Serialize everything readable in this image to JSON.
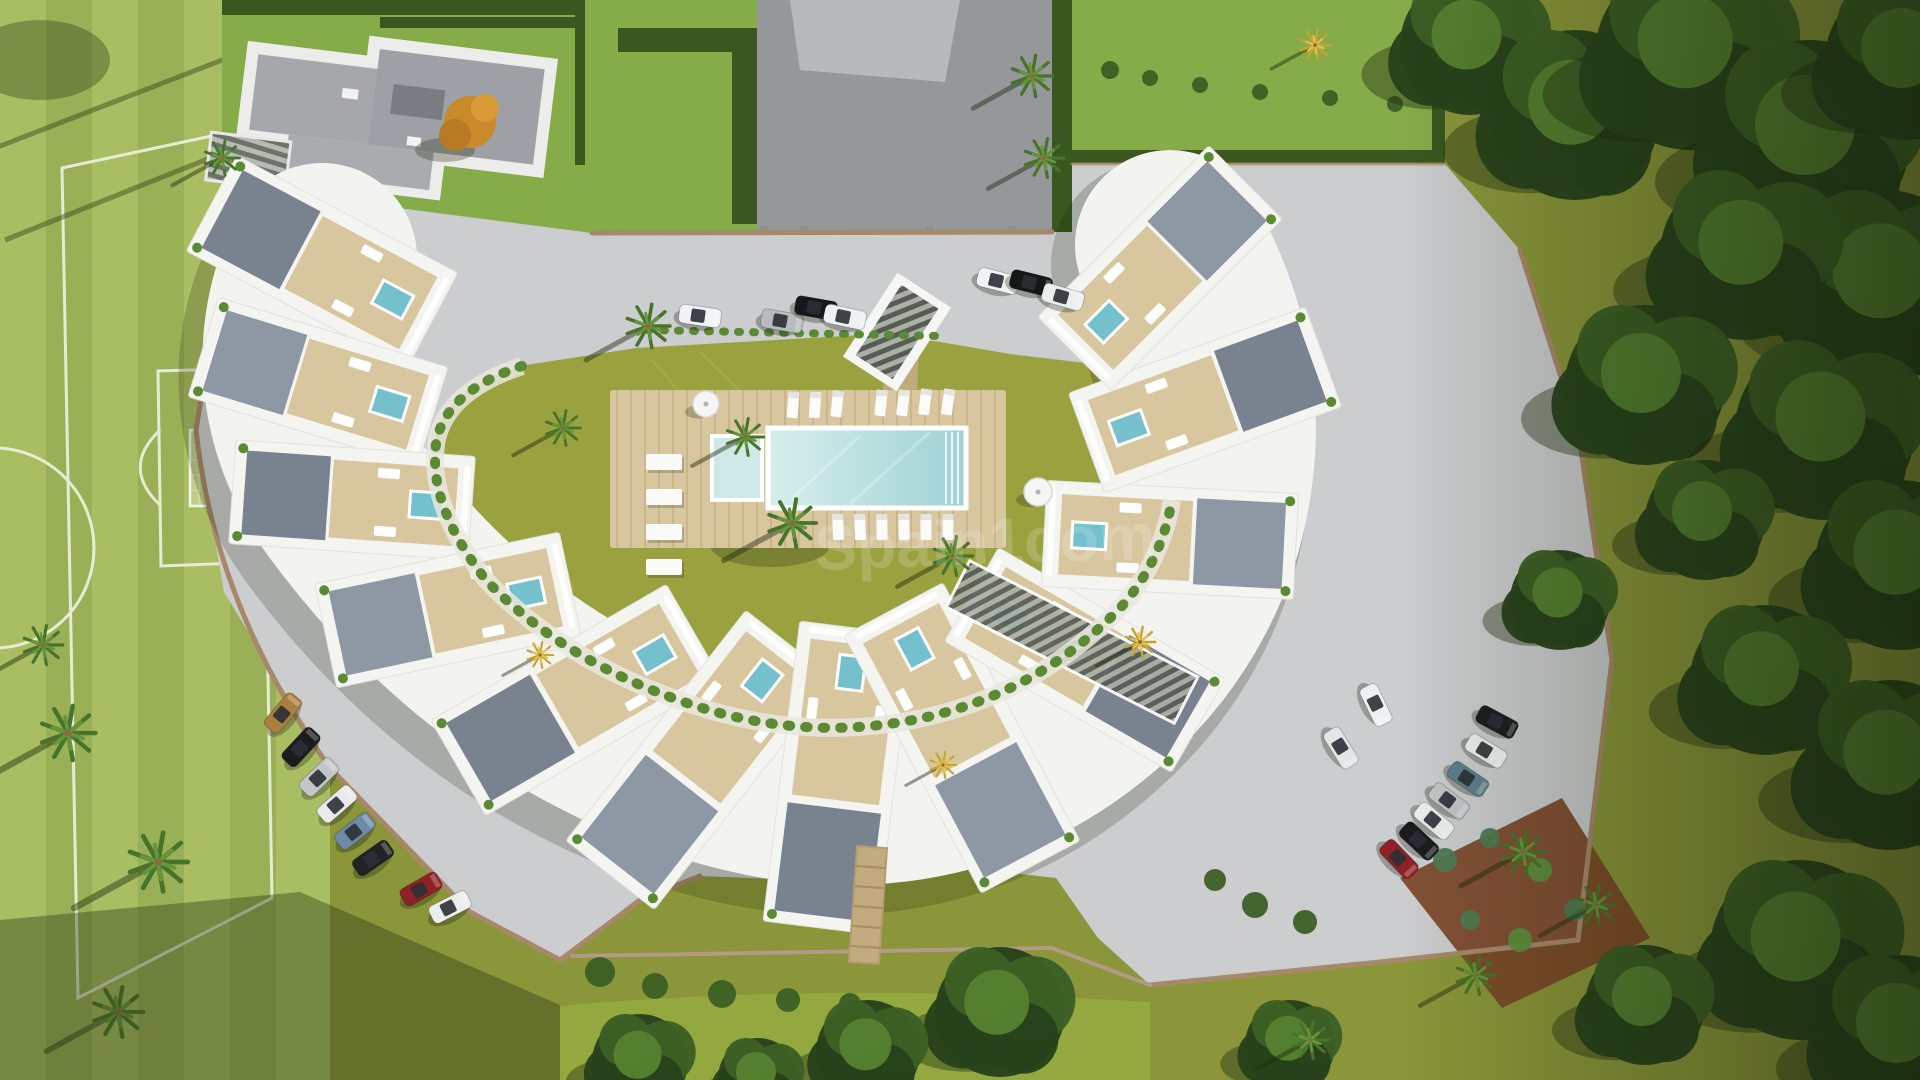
{
  "meta": {
    "description": "Aerial 3D render of a crescent-shaped apartment complex with communal pool, gardens, parking and a football pitch"
  },
  "watermark": {
    "text": "Spain1com",
    "color": "#ffffff",
    "opacity": 0.17
  },
  "palette": {
    "pitch_light": "#a9bd62",
    "pitch_dark": "#9ab056",
    "line": "#edf1de",
    "lawn_yellow": "#9aa23f",
    "lawn_bright": "#86ab49",
    "lawn_olive": "#8a9639",
    "hedge": "#39571f",
    "tree_dark": "#27421b",
    "tree_mid": "#3c5f24",
    "tree_light": "#55802f",
    "paving": "#cbcdce",
    "paving_dark": "#94989a",
    "building": "#f4f4f1",
    "roof_a": "#78838f",
    "roof_b": "#8d98a4",
    "deck": "#d8c69e",
    "wood": "#c2ab7e",
    "water": "#b7e0de",
    "water_deep": "#74c0cc",
    "planter": "#5c8a33",
    "wall": "#a8886a",
    "soil": "#7c4527",
    "glass": "#2a2f36"
  },
  "scene": {
    "blocks": [
      {
        "x": 322,
        "y": 262,
        "a": 208,
        "l": 250,
        "w": 108
      },
      {
        "x": 318,
        "y": 382,
        "a": 197,
        "l": 240,
        "w": 104
      },
      {
        "x": 352,
        "y": 500,
        "a": 184,
        "l": 240,
        "w": 104
      },
      {
        "x": 448,
        "y": 610,
        "a": 168,
        "l": 250,
        "w": 106
      },
      {
        "x": 576,
        "y": 700,
        "a": 150,
        "l": 272,
        "w": 110
      },
      {
        "x": 700,
        "y": 760,
        "a": 128,
        "l": 292,
        "w": 112
      },
      {
        "x": 838,
        "y": 778,
        "a": 97,
        "l": 302,
        "w": 114
      },
      {
        "x": 962,
        "y": 738,
        "a": 62,
        "l": 292,
        "w": 112
      },
      {
        "x": 1085,
        "y": 660,
        "a": 30,
        "l": 262,
        "w": 108
      },
      {
        "x": 1170,
        "y": 540,
        "a": 3,
        "l": 252,
        "w": 106
      },
      {
        "x": 1205,
        "y": 400,
        "a": -20,
        "l": 252,
        "w": 106
      },
      {
        "x": 1160,
        "y": 268,
        "a": -45,
        "l": 242,
        "w": 104
      }
    ],
    "cars": [
      {
        "x": 700,
        "y": 316,
        "r": 8,
        "c": "#f2f3f4"
      },
      {
        "x": 782,
        "y": 321,
        "r": 10,
        "c": "#b9bcbf"
      },
      {
        "x": 816,
        "y": 308,
        "r": 10,
        "c": "#17181a"
      },
      {
        "x": 845,
        "y": 317,
        "r": 12,
        "c": "#eef0f1"
      },
      {
        "x": 998,
        "y": 281,
        "r": 14,
        "c": "#f1f2f3"
      },
      {
        "x": 1031,
        "y": 283,
        "r": 14,
        "c": "#141618"
      },
      {
        "x": 1063,
        "y": 297,
        "r": 16,
        "c": "#eceeef"
      },
      {
        "x": 283,
        "y": 713,
        "r": -50,
        "c": "#a97f3f"
      },
      {
        "x": 301,
        "y": 747,
        "r": -47,
        "c": "#1a1c1e"
      },
      {
        "x": 319,
        "y": 777,
        "r": -44,
        "c": "#c4c7c9"
      },
      {
        "x": 337,
        "y": 804,
        "r": -41,
        "c": "#e9eaeb"
      },
      {
        "x": 355,
        "y": 831,
        "r": -38,
        "c": "#6d8ba6"
      },
      {
        "x": 373,
        "y": 858,
        "r": -35,
        "c": "#202224"
      },
      {
        "x": 421,
        "y": 889,
        "r": -30,
        "c": "#8f2025"
      },
      {
        "x": 450,
        "y": 907,
        "r": -27,
        "c": "#eceded"
      },
      {
        "x": 1497,
        "y": 722,
        "r": 28,
        "c": "#1b1d1f"
      },
      {
        "x": 1486,
        "y": 751,
        "r": 31,
        "c": "#eef0f0"
      },
      {
        "x": 1468,
        "y": 779,
        "r": 34,
        "c": "#5d808c"
      },
      {
        "x": 1449,
        "y": 801,
        "r": 37,
        "c": "#c3c6c8"
      },
      {
        "x": 1434,
        "y": 821,
        "r": 40,
        "c": "#edeeee"
      },
      {
        "x": 1419,
        "y": 841,
        "r": 43,
        "c": "#191b1d"
      },
      {
        "x": 1399,
        "y": 859,
        "r": 46,
        "c": "#8e2126"
      },
      {
        "x": 1376,
        "y": 705,
        "r": 64,
        "c": "#eff0f1"
      },
      {
        "x": 1341,
        "y": 748,
        "r": 58,
        "c": "#e3e5e6"
      }
    ],
    "loungers": [
      {
        "x": 793,
        "y": 405,
        "r": 94
      },
      {
        "x": 815,
        "y": 405,
        "r": 94
      },
      {
        "x": 837,
        "y": 404,
        "r": 96
      },
      {
        "x": 881,
        "y": 403,
        "r": 96
      },
      {
        "x": 903,
        "y": 403,
        "r": 97
      },
      {
        "x": 925,
        "y": 402,
        "r": 97
      },
      {
        "x": 948,
        "y": 402,
        "r": 98
      },
      {
        "x": 838,
        "y": 527,
        "r": 88
      },
      {
        "x": 860,
        "y": 527,
        "r": 88
      },
      {
        "x": 882,
        "y": 527,
        "r": 89
      },
      {
        "x": 904,
        "y": 527,
        "r": 89
      },
      {
        "x": 926,
        "y": 527,
        "r": 90
      },
      {
        "x": 948,
        "y": 527,
        "r": 90
      }
    ],
    "slabs": [
      {
        "x": 664,
        "y": 462
      },
      {
        "x": 664,
        "y": 497
      },
      {
        "x": 664,
        "y": 532
      },
      {
        "x": 664,
        "y": 567
      }
    ],
    "umbrellas": [
      {
        "x": 706,
        "y": 404,
        "r": 13
      },
      {
        "x": 1038,
        "y": 492,
        "r": 14
      }
    ],
    "palms": [
      {
        "x": 648,
        "y": 326,
        "s": 1.0,
        "t": "green"
      },
      {
        "x": 745,
        "y": 437,
        "s": 0.85,
        "t": "green"
      },
      {
        "x": 792,
        "y": 523,
        "s": 1.1,
        "t": "green"
      },
      {
        "x": 563,
        "y": 428,
        "s": 0.8,
        "t": "green"
      },
      {
        "x": 953,
        "y": 556,
        "s": 0.9,
        "t": "green"
      },
      {
        "x": 222,
        "y": 158,
        "s": 0.8,
        "t": "green"
      },
      {
        "x": 1032,
        "y": 76,
        "s": 0.95,
        "t": "green"
      },
      {
        "x": 1044,
        "y": 158,
        "s": 0.9,
        "t": "green"
      },
      {
        "x": 68,
        "y": 733,
        "s": 1.25,
        "t": "green"
      },
      {
        "x": 158,
        "y": 862,
        "s": 1.35,
        "t": "green"
      },
      {
        "x": 118,
        "y": 1012,
        "s": 1.15,
        "t": "green"
      },
      {
        "x": 43,
        "y": 645,
        "s": 0.9,
        "t": "green"
      },
      {
        "x": 1523,
        "y": 852,
        "s": 1.0,
        "t": "green"
      },
      {
        "x": 1596,
        "y": 905,
        "s": 0.9,
        "t": "green"
      },
      {
        "x": 1476,
        "y": 975,
        "s": 0.9,
        "t": "green"
      },
      {
        "x": 1310,
        "y": 1040,
        "s": 0.85,
        "t": "green"
      },
      {
        "x": 540,
        "y": 655,
        "s": 0.6,
        "t": "gold"
      },
      {
        "x": 943,
        "y": 765,
        "s": 0.6,
        "t": "gold"
      },
      {
        "x": 1315,
        "y": 45,
        "s": 0.7,
        "t": "gold"
      },
      {
        "x": 1140,
        "y": 642,
        "s": 0.7,
        "t": "gold"
      }
    ],
    "trees": [
      {
        "x": 1470,
        "y": 45,
        "rr": 70
      },
      {
        "x": 1575,
        "y": 115,
        "rr": 85
      },
      {
        "x": 1690,
        "y": 55,
        "rr": 95
      },
      {
        "x": 1810,
        "y": 140,
        "rr": 100
      },
      {
        "x": 1905,
        "y": 60,
        "rr": 80
      },
      {
        "x": 1885,
        "y": 285,
        "rr": 95
      },
      {
        "x": 1745,
        "y": 255,
        "rr": 85
      },
      {
        "x": 1645,
        "y": 385,
        "rr": 80
      },
      {
        "x": 1825,
        "y": 430,
        "rr": 90
      },
      {
        "x": 1900,
        "y": 565,
        "rr": 85
      },
      {
        "x": 1705,
        "y": 520,
        "rr": 60
      },
      {
        "x": 1765,
        "y": 680,
        "rr": 75
      },
      {
        "x": 1890,
        "y": 765,
        "rr": 85
      },
      {
        "x": 1800,
        "y": 950,
        "rr": 90
      },
      {
        "x": 1900,
        "y": 1035,
        "rr": 80
      },
      {
        "x": 1645,
        "y": 1005,
        "rr": 60
      },
      {
        "x": 1560,
        "y": 600,
        "rr": 50
      },
      {
        "x": 1000,
        "y": 1012,
        "rr": 65
      },
      {
        "x": 868,
        "y": 1052,
        "rr": 52
      },
      {
        "x": 640,
        "y": 1062,
        "rr": 48
      },
      {
        "x": 758,
        "y": 1078,
        "rr": 40
      },
      {
        "x": 1290,
        "y": 1045,
        "rr": 45
      }
    ],
    "bushes": [
      {
        "x": 600,
        "y": 972,
        "r": 15
      },
      {
        "x": 655,
        "y": 986,
        "r": 13
      },
      {
        "x": 722,
        "y": 994,
        "r": 14
      },
      {
        "x": 788,
        "y": 1000,
        "r": 12
      },
      {
        "x": 850,
        "y": 1004,
        "r": 11
      },
      {
        "x": 1255,
        "y": 905,
        "r": 13
      },
      {
        "x": 1305,
        "y": 922,
        "r": 12
      },
      {
        "x": 1215,
        "y": 880,
        "r": 11
      },
      {
        "x": 1445,
        "y": 860,
        "r": 12,
        "c": "#4c7a52"
      },
      {
        "x": 1490,
        "y": 838,
        "r": 10,
        "c": "#4c7a52"
      },
      {
        "x": 1540,
        "y": 870,
        "r": 12,
        "c": "#5d8f3d"
      },
      {
        "x": 1575,
        "y": 910,
        "r": 11,
        "c": "#4c7a52"
      },
      {
        "x": 1520,
        "y": 940,
        "r": 12,
        "c": "#5d8f3d"
      },
      {
        "x": 1470,
        "y": 920,
        "r": 10,
        "c": "#4c7a52"
      },
      {
        "x": 1110,
        "y": 70,
        "r": 9
      },
      {
        "x": 1150,
        "y": 78,
        "r": 8
      },
      {
        "x": 1200,
        "y": 85,
        "r": 8
      },
      {
        "x": 1260,
        "y": 92,
        "r": 8
      },
      {
        "x": 1330,
        "y": 98,
        "r": 8
      },
      {
        "x": 1395,
        "y": 104,
        "r": 8
      }
    ]
  }
}
